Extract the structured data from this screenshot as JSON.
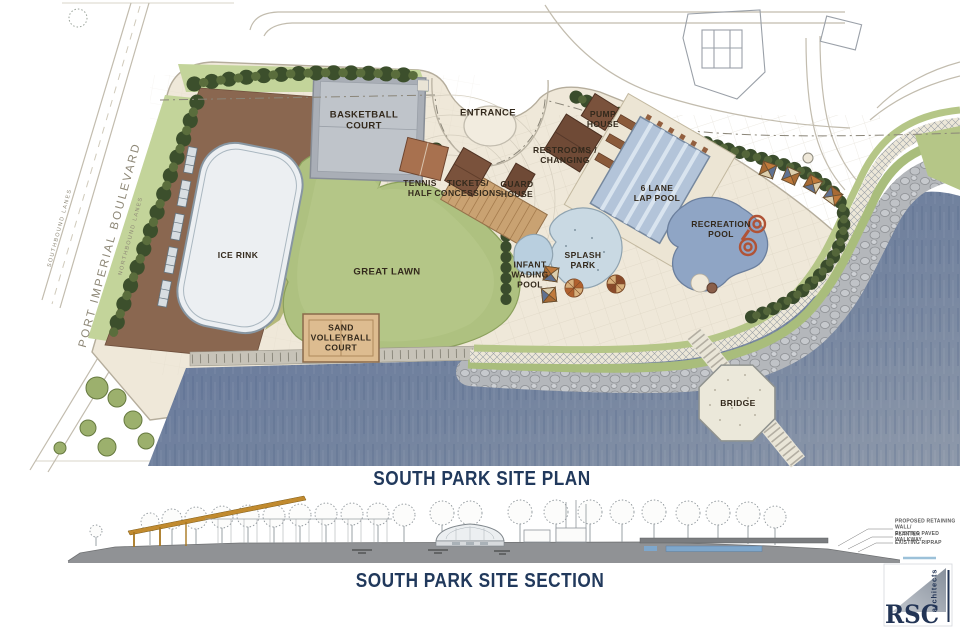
{
  "plan": {
    "title": "SOUTH PARK SITE PLAN",
    "street": {
      "name": "PORT IMPERIAL BOULEVARD",
      "southbound": "SOUTHBOUND LANES",
      "northbound": "NORTHBOUND LANES"
    },
    "features": {
      "basketball_court": "BASKETBALL\nCOURT",
      "entrance": "ENTRANCE",
      "tennis_half": "TENNIS\nHALF",
      "tickets_concessions": "TICKETS/\nCONCESSIONS",
      "guard_house": "GUARD\nHOUSE",
      "pump_house": "PUMP\nHOUSE",
      "restrooms_changing": "RESTROOMS /\nCHANGING",
      "lap_pool": "6 LANE\nLAP POOL",
      "recreation_pool": "RECREATION\nPOOL",
      "splash_park": "SPLASH\nPARK",
      "infant_wading_pool": "INFANT\nWADING\nPOOL",
      "ice_rink": "ICE RINK",
      "great_lawn": "GREAT LAWN",
      "sand_volleyball": "SAND\nVOLLEYBALL\nCOURT",
      "bridge": "BRIDGE"
    }
  },
  "section": {
    "title": "SOUTH PARK SITE SECTION",
    "annotations": [
      "PROPOSED RETAINING WALL/\nPLANTER",
      "EXISTING PAVED WALKWAY",
      "EXISTING RIPRAP"
    ]
  },
  "logo": {
    "firm": "RSC",
    "descriptor": "architects"
  },
  "palette": {
    "water": "#6b7d9d",
    "lawn": "#aec180",
    "paving": "#efe8d9",
    "plaza_brown": "#8a6750",
    "building_brown": "#6f4a36",
    "pool_blue": "#b3c4d9",
    "tree_green": "#3c4f2c",
    "title_navy": "#21395c"
  }
}
